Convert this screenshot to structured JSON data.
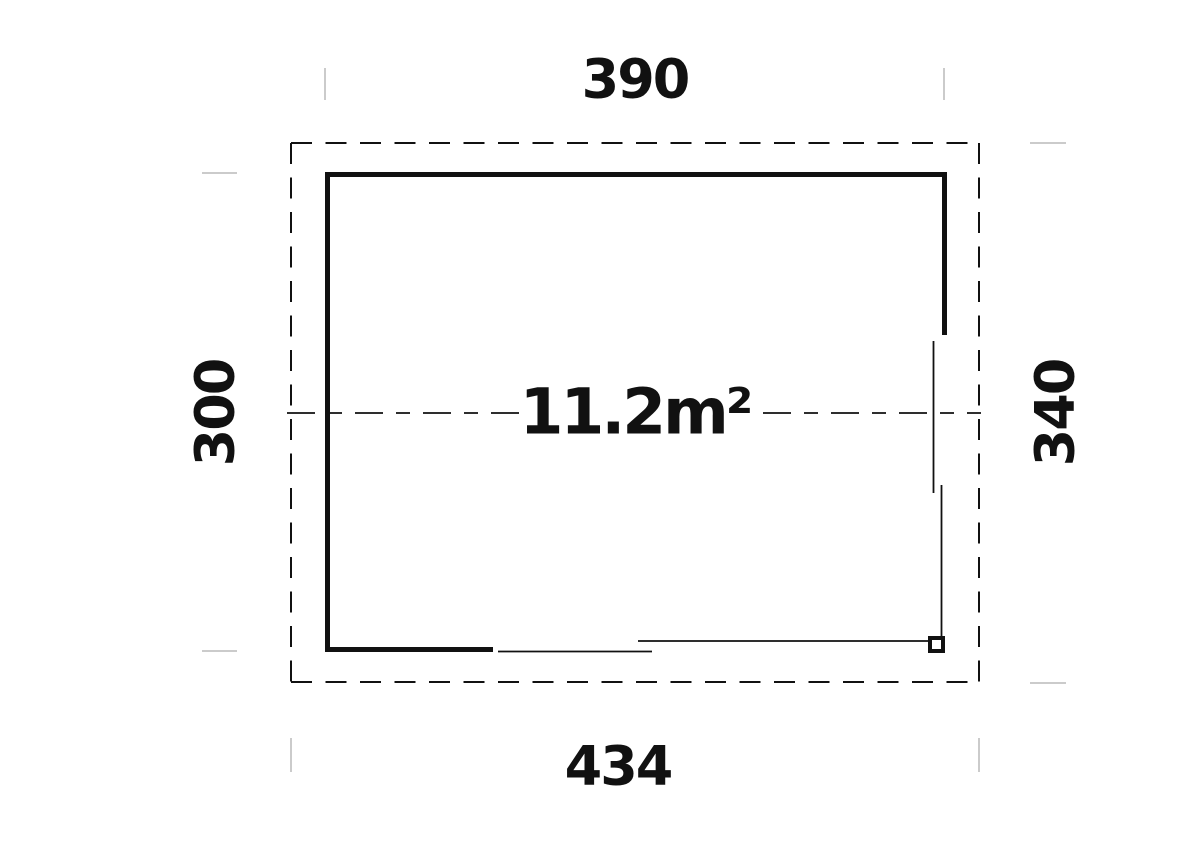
{
  "plan": {
    "area_label": "11.2m²",
    "dim_top": "390",
    "dim_bottom": "434",
    "dim_left": "300",
    "dim_right": "340"
  },
  "colors": {
    "line": "#111111",
    "tick": "#cbcbcb",
    "background": "#ffffff"
  }
}
